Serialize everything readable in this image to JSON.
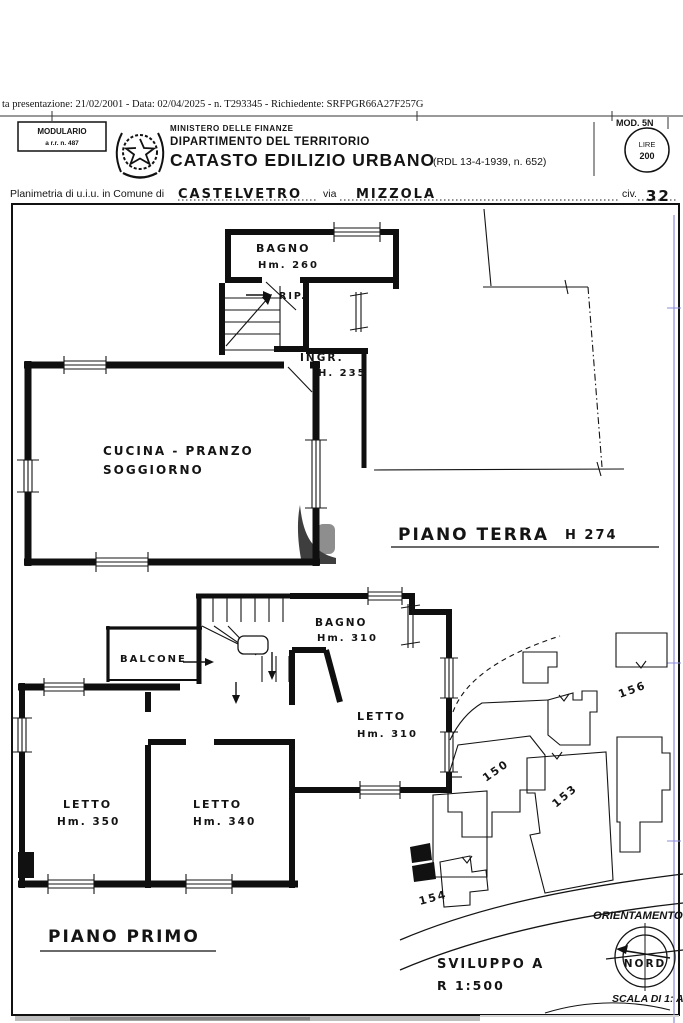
{
  "header": {
    "presentation_line": "ta presentazione: 21/02/2001 - Data: 02/04/2025 - n. T293345 - Richiedente: SRFPGR66A27F257G",
    "modulario_line1": "MODULARIO",
    "modulario_line2": "a r.r. n. 487",
    "ministero": "MINISTERO DELLE FINANZE",
    "dipartimento": "DIPARTIMENTO DEL TERRITORIO",
    "catasto": "CATASTO EDILIZIO URBANO",
    "catasto_ref": "(RDL 13-4-1939, n. 652)",
    "mod_label": "MOD. 5N",
    "stamp_line1": "LIRE",
    "stamp_line2": "200"
  },
  "planimetria": {
    "prefix": "Planimetria di u.i.u. in Comune di",
    "comune": "CASTELVETRO",
    "via_label": "via",
    "via_value": "MIZZOLA",
    "civ_label": "civ.",
    "civ_value": "32"
  },
  "ground_floor": {
    "title": "PIANO TERRA",
    "title_height": "H 274",
    "bagno": "BAGNO",
    "bagno_h": "Hm. 260",
    "rip": "RIP.",
    "ingresso": "INGR.",
    "ingresso_h": "H. 235",
    "cucina_line1": "CUCINA - PRANZO",
    "cucina_line2": "SOGGIORNO"
  },
  "first_floor": {
    "title": "PIANO PRIMO",
    "bagno": "BAGNO",
    "bagno_h": "Hm. 310",
    "balcone": "BALCONE",
    "letto_right": "LETTO",
    "letto_right_h": "Hm. 310",
    "letto_left": "LETTO",
    "letto_left_h": "Hm. 350",
    "letto_mid": "LETTO",
    "letto_mid_h": "Hm. 340"
  },
  "site_plan": {
    "parcel_150": "150",
    "parcel_153": "153",
    "parcel_154": "154",
    "parcel_156": "156",
    "sviluppo_line1": "SVILUPPO A",
    "sviluppo_line2": "R 1:500",
    "orientamento": "ORIENTAMENTO",
    "nord": "NORD",
    "scala": "SCALA DI 1: A"
  },
  "colors": {
    "ink": "#121212",
    "blue_fold_mark": "#8c8cd9",
    "watermark_dark": "#3e3e3e",
    "watermark_light": "#8e8e8e",
    "scan_strip_gray": "#a8a8a8"
  }
}
